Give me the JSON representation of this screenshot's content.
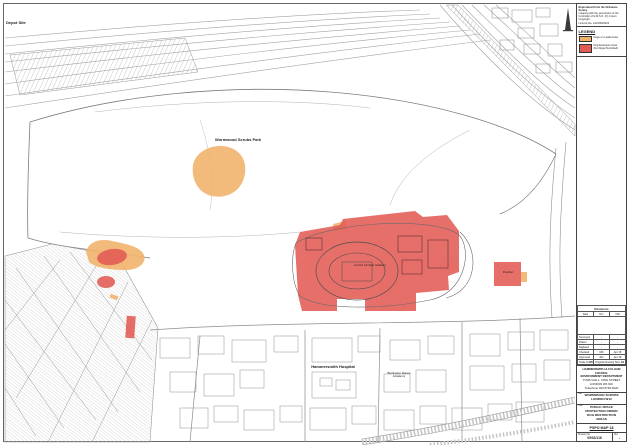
{
  "colors": {
    "dog_exclusion_red": "#e25b55",
    "dogs_on_lead_orange": "#f2b46d",
    "linework_gray": "#9a9a9a"
  },
  "map": {
    "labels": {
      "depot_site": "Depot Site",
      "park": "Wormwood Scrubs Park",
      "stadium": "Linford Christie Stadium",
      "hospital": "Hammersmith Hospital",
      "academy_line1": "Burlington Danes",
      "academy_line2": "Academy",
      "pavilion": "Pavilion"
    }
  },
  "sidebar": {
    "stamp_lines": [
      "Reproduced from the Ordnance Survey",
      "mapping with the permission of the",
      "Controller of H.M.S.O. (C) Crown Copyright",
      "Licence No. LA100019223"
    ],
    "legend": {
      "title": "LEGEND",
      "items": [
        {
          "label": "Dogs on Leads Area"
        },
        {
          "label": "Dog Exclusion Area"
        },
        {
          "label": "(No Dogs Permitted)"
        }
      ]
    },
    "revisions": {
      "title": "Revisions",
      "columns": [
        "Date",
        "Drn",
        "Chk"
      ],
      "details": [
        {
          "label": "Surveyed",
          "v1": "-",
          "v2": "-"
        },
        {
          "label": "Drawn",
          "v1": "-",
          "v2": "-"
        },
        {
          "label": "Digitised",
          "v1": "-",
          "v2": "-"
        },
        {
          "label": "Checked",
          "v1": "MD",
          "v2": "Apr 18"
        },
        {
          "label": "Approved",
          "v1": "RH",
          "v2": "Apr 18"
        }
      ],
      "scale_label": "Scale",
      "scale_value": "1:1250",
      "size_label": "Original Drawing Size",
      "size_value": "A3"
    },
    "address_lines": [
      "HAMMERSMITH & FULHAM",
      "COUNCIL",
      "ENVIRONMENT DEPARTMENT",
      "TOWN HALL, KING STREET",
      "LONDON W6 9JU",
      "Telephone 020 8748 3020"
    ],
    "site": {
      "heading": "Site",
      "lines": [
        "WORMWOOD SCRUBS",
        "LONDON W12"
      ]
    },
    "drawing_title": {
      "heading": "Title",
      "lines": [
        "PUBLIC SPACE",
        "PROTECTION ORDER",
        "DOG RESTRICTION",
        "AREAS"
      ]
    },
    "map_no": "PSPO MAP 18",
    "footer": {
      "drawing_no_label": "Drawing No.",
      "drawing_no": "05/02/118",
      "rev_label": "Rev",
      "rev": "-"
    }
  }
}
